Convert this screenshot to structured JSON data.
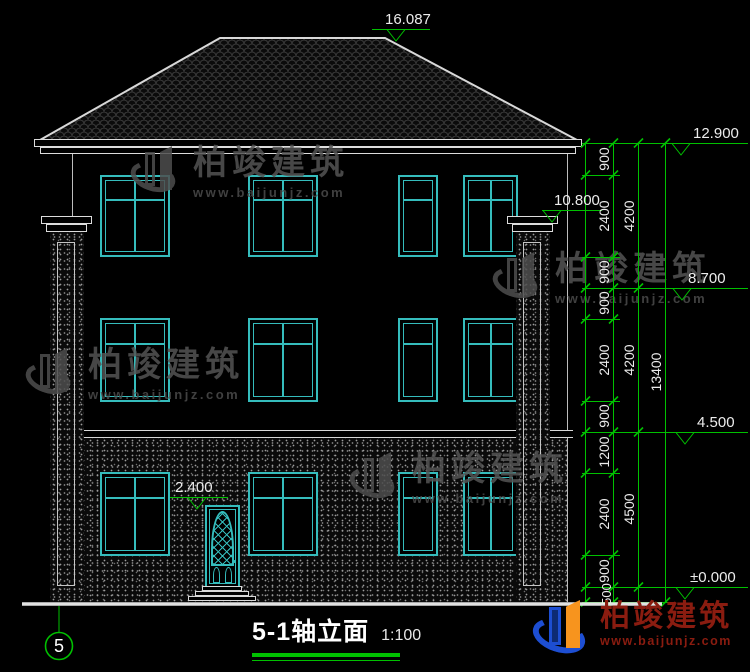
{
  "title_block": {
    "title": "5-1轴立面",
    "scale": "1:100",
    "axis_label": "5"
  },
  "markers": {
    "ridge": "16.087",
    "roof_eave": "12.900",
    "wall_top": "10.800",
    "level3": "8.700",
    "level2": "4.500",
    "ground": "±0.000",
    "door_top": "2.400"
  },
  "dimensions": {
    "chain_a": [
      "900",
      "2400",
      "900",
      "900",
      "2400",
      "900",
      "1200",
      "2400",
      "900",
      "500"
    ],
    "chain_b": [
      "4200",
      "4200",
      "4500"
    ],
    "total": "13400"
  },
  "watermark": {
    "name": "柏竣建筑",
    "url": "www.baijunjz.com"
  },
  "brand": {
    "name": "柏竣建筑",
    "url": "www.baijunjz.com"
  },
  "colors": {
    "dimension_green": "#00c000",
    "window_cyan": "#35bcbc",
    "brand_red": "#8a1c10",
    "logo_blue": "#1d4ed2",
    "logo_orange": "#f7941e"
  }
}
